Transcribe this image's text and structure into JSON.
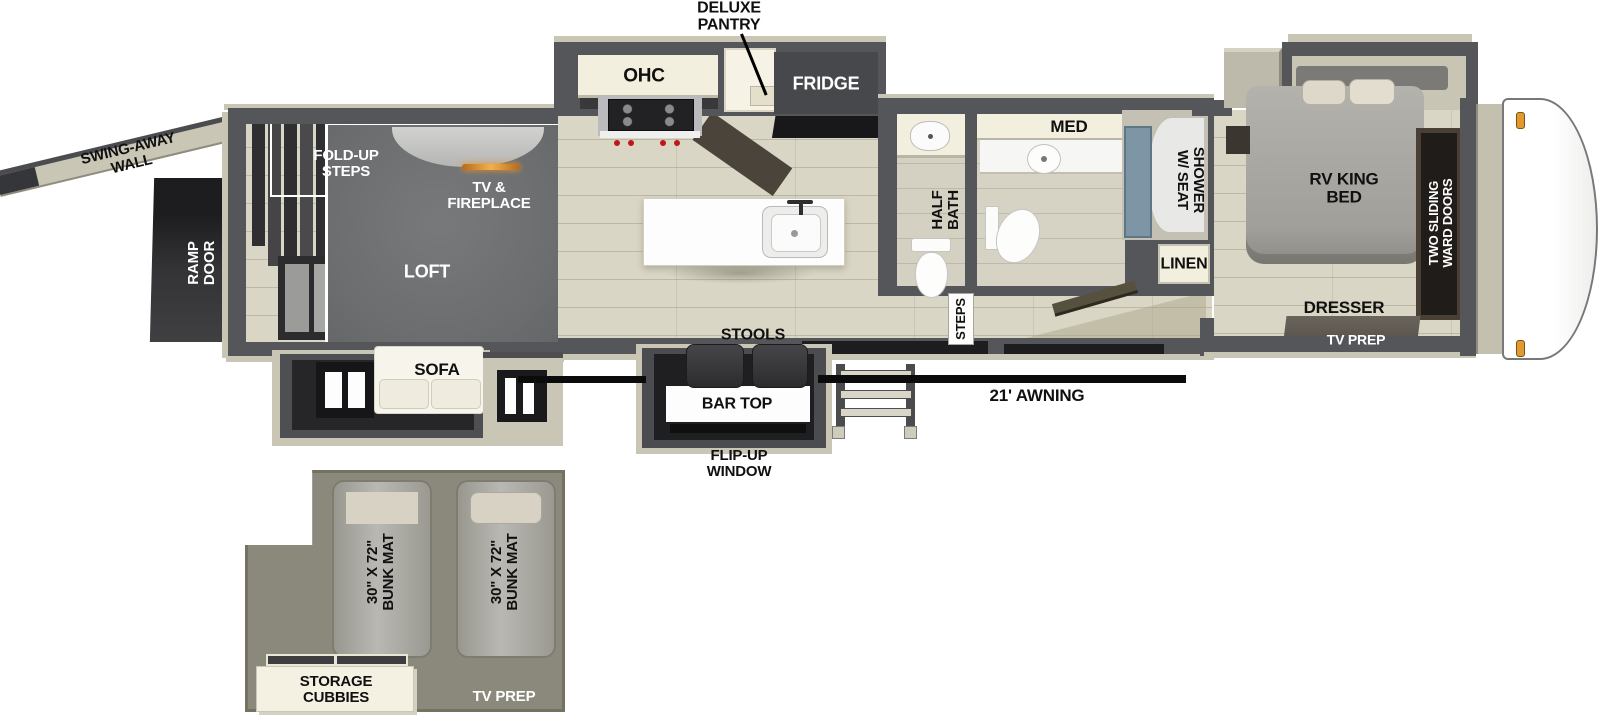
{
  "diagram": {
    "type": "rv-floorplan",
    "labels": {
      "deluxe_pantry": "DELUXE\nPANTRY",
      "ohc": "OHC",
      "fridge": "FRIDGE",
      "med": "MED",
      "shower_w_seat": "SHOWER\nW/ SEAT",
      "half_bath": "HALF\nBATH",
      "linen": "LINEN",
      "steps": "STEPS",
      "rv_king_bed": "RV KING\nBED",
      "two_sliding_ward_doors": "TWO SLIDING\nWARD DOORS",
      "dresser": "DRESSER",
      "tv_prep_bedroom": "TV PREP",
      "swing_away_wall": "SWING-AWAY\nWALL",
      "ramp_door": "RAMP\nDOOR",
      "fold_up_steps": "FOLD-UP\nSTEPS",
      "tv_fireplace": "TV &\nFIREPLACE",
      "loft": "LOFT",
      "sofa": "SOFA",
      "stools": "STOOLS",
      "bar_top": "BAR TOP",
      "flip_up_window": "FLIP-UP\nWINDOW",
      "awning": "21' AWNING",
      "bunk_mat_left": "30\" X 72\"\nBUNK MAT",
      "bunk_mat_right": "30\" X 72\"\nBUNK MAT",
      "storage_cubbies": "STORAGE\nCUBBIES",
      "tv_prep_bunk": "TV PREP"
    },
    "colors": {
      "wall": "#55565a",
      "floor": "#d9d6c5",
      "exterior_putty": "#c9c6b6",
      "cabinet_cream": "#f2efde",
      "loft_gray": "#6f7173",
      "bunkroom_olive": "#8b897c",
      "shower_glass": "#7e95a5",
      "awning_line": "#0b0b0b",
      "fireplace_glow": "#e8952f",
      "marker_light": "#e09a2e"
    }
  }
}
